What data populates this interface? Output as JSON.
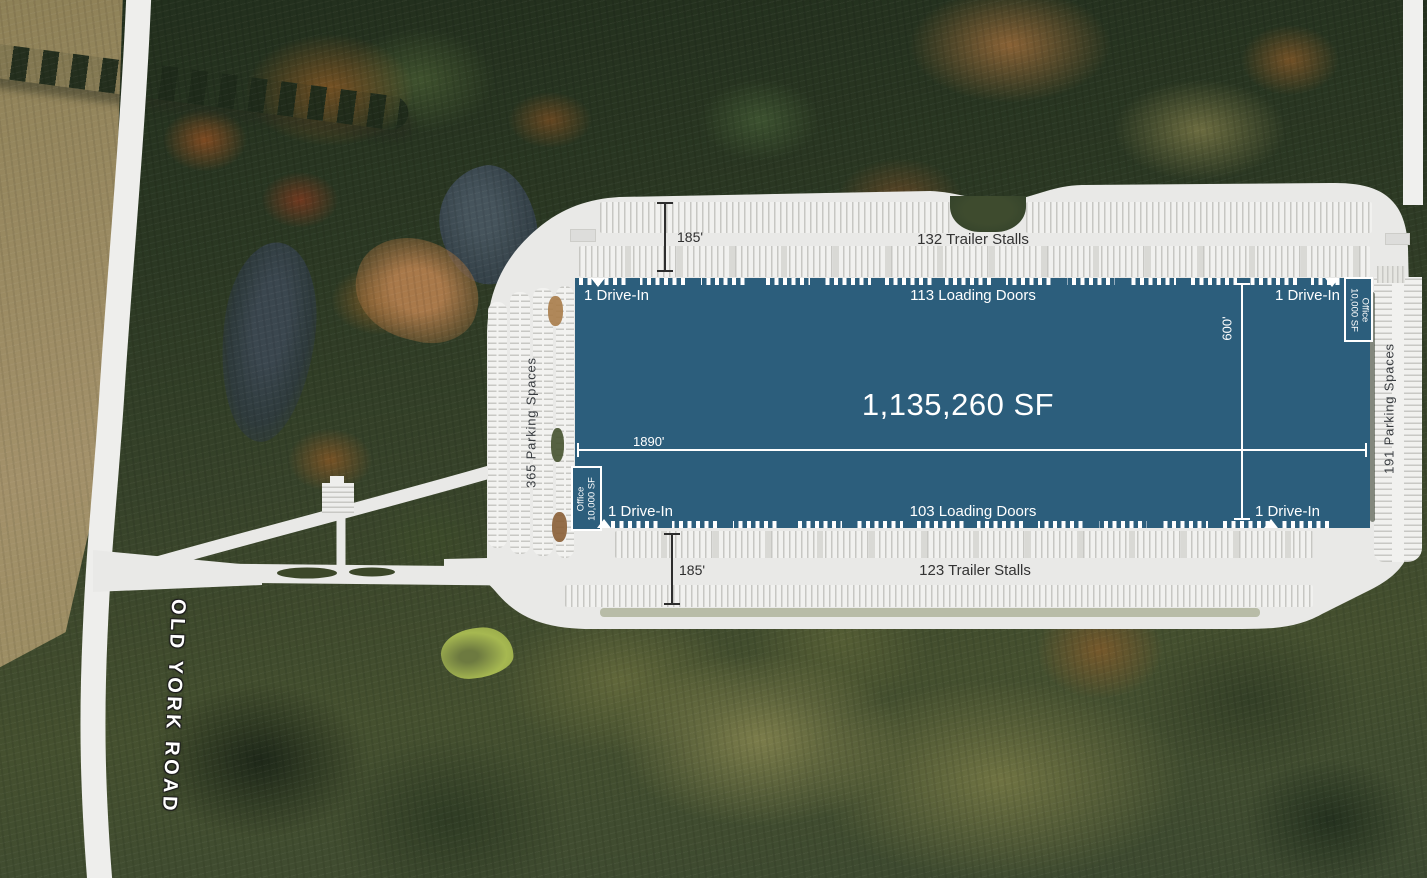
{
  "road": {
    "label": "OLD YORK ROAD"
  },
  "building": {
    "area": "1,135,260 SF",
    "length": "1890'",
    "depth": "600'",
    "north": {
      "drive_in_left": "1 Drive-In",
      "loading_doors": "113 Loading Doors",
      "drive_in_right": "1 Drive-In"
    },
    "south": {
      "drive_in_left": "1 Drive-In",
      "loading_doors": "103 Loading Doors",
      "drive_in_right": "1 Drive-In"
    },
    "office_ne": {
      "line1": "Office",
      "line2": "10,000 SF"
    },
    "office_sw": {
      "line1": "Office",
      "line2": "10,000 SF"
    }
  },
  "north_court": {
    "depth": "185'",
    "stalls": "132 Trailer Stalls"
  },
  "south_court": {
    "depth": "185'",
    "stalls": "123 Trailer Stalls"
  },
  "west_lot": {
    "label": "365 Parking Spaces"
  },
  "east_lot": {
    "label": "191 Parking Spaces"
  },
  "colors": {
    "building": "#2c5e7c",
    "pavement": "#e9e9e7",
    "dimension_dark": "#2d2d2d",
    "dimension_light": "#ffffff",
    "label_dark": "#333333"
  }
}
